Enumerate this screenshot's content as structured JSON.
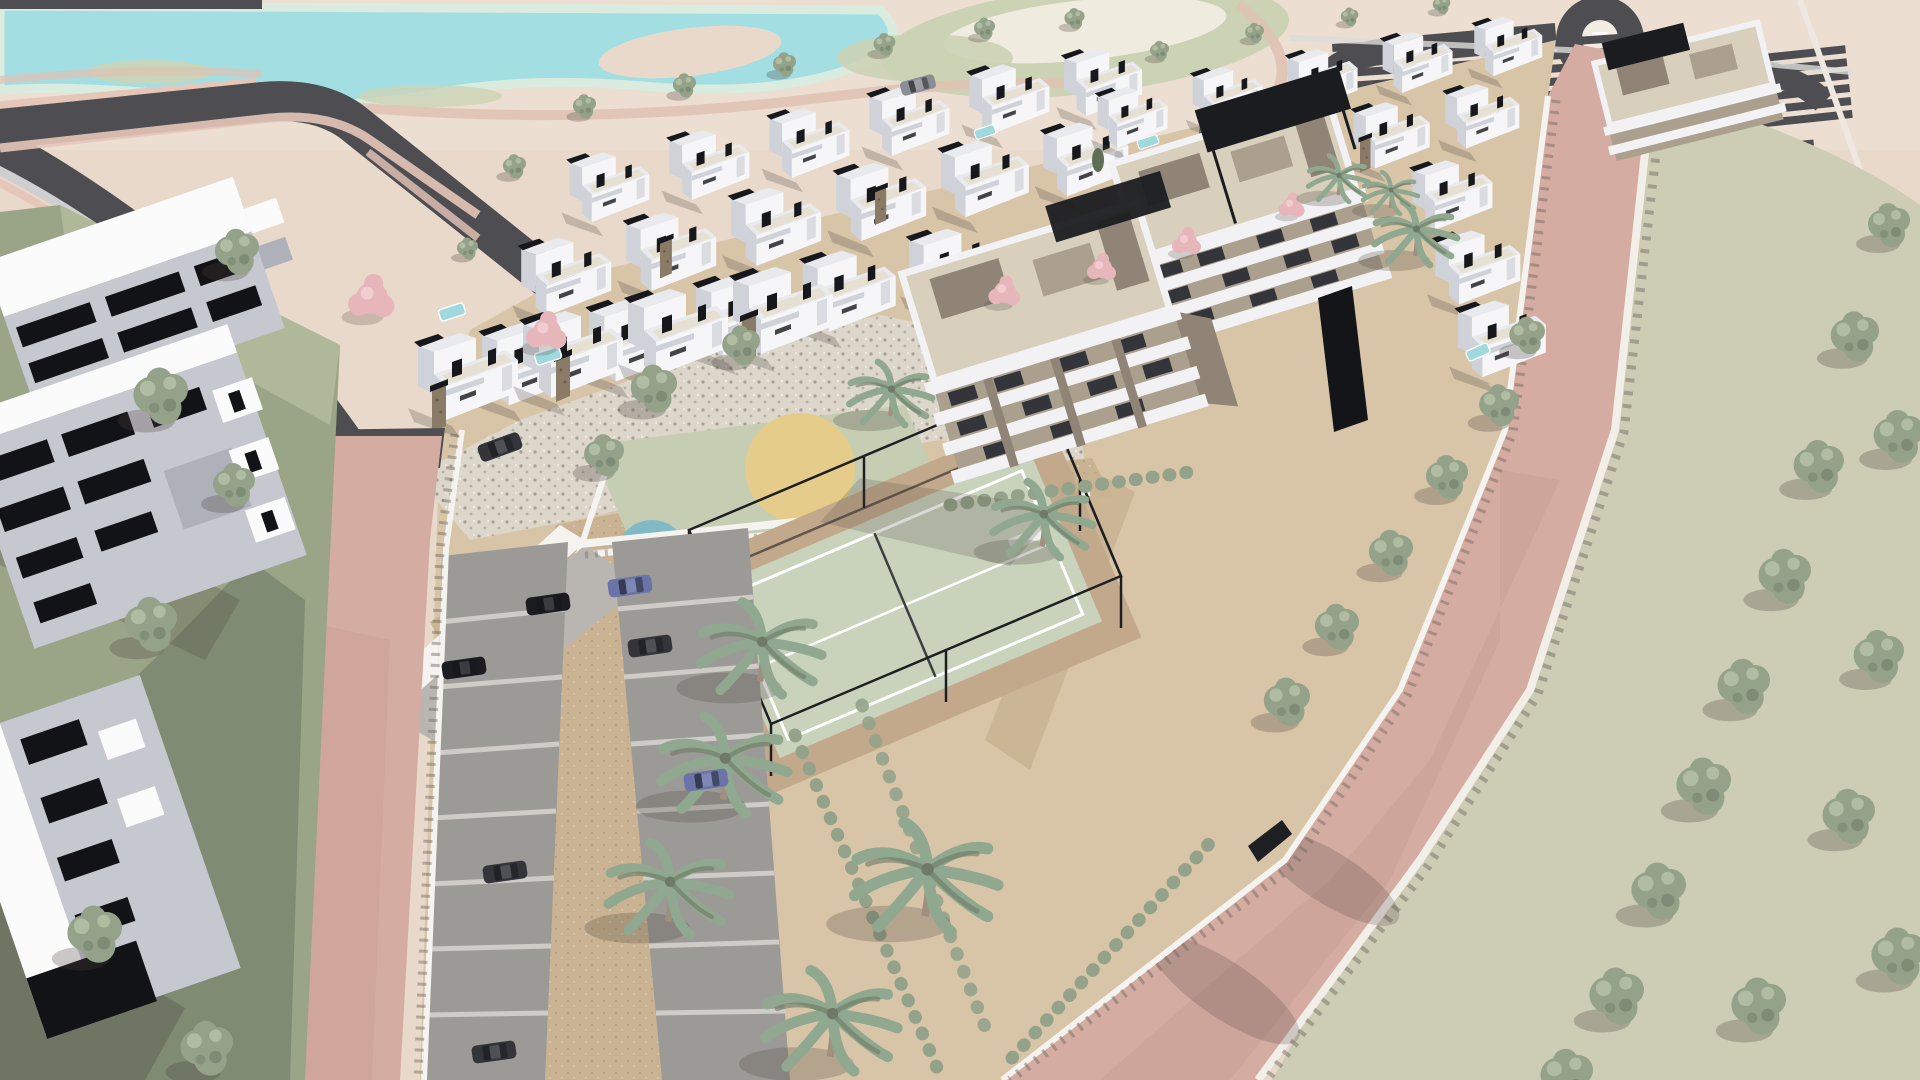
{
  "scene": {
    "type": "3d-architectural-render",
    "view": "aerial-perspective",
    "description": "Aerial visualization of a walled residential development: rows of white two-storey villas, two taupe-and-white apartment blocks with rooftop pergolas, a fenced padel court, a children's playground with three colored circles, surface parking with cars, an underground-garage ramp, palm and street trees, pink asphalt perimeter roads, a lawn verge with a tree row, and a golf course with a turquoise lake behind."
  },
  "palette": {
    "bg_sand": "#e9d9ca",
    "sand_light": "#f0e4d7",
    "lake": "#a3dee3",
    "lake_rim": "#d9ecdf",
    "fairway": "#ccd3b5",
    "fairway_cream": "#f0ebdf",
    "ribbon_pink": "#dfc2b4",
    "road_dark": "#4e4e52",
    "road_pink": "#d5aca2",
    "road_pink_deep": "#c89d94",
    "curb_white": "#f2efe9",
    "verge": "#cdccb5",
    "sidewalk_gray": "#cfcfd1",
    "sidewalk_pink": "#e6c6b8",
    "plot_sand": "#d8c5a8",
    "cobble_base": "#dcd6cb",
    "cobble_dot": "#8e877c",
    "paver_tan": "#c9b392",
    "paver_dot": "#a98f6d",
    "stall_gray": "#9c9a97",
    "stall_line": "#cfccc7",
    "court_green": "#c9d3bc",
    "court_line": "#ffffff",
    "court_sand": "#c3a98c",
    "fence_dark": "#1e1f23",
    "wall_white": "#f4f3f0",
    "wall_shadow": "#6f665e",
    "villa_white": "#f6f6f8",
    "villa_side": "#cfd2d9",
    "villa_roof": "#e9eaee",
    "villa_terrace": "#e6e0d2",
    "villa_dark": "#17181b",
    "stone": "#8a7b66",
    "pool": "#9fd8dd",
    "apt_taupe": "#ab9f8e",
    "apt_taupe_dark": "#8f8475",
    "apt_deck": "#d8cfbd",
    "apt_white": "#f2f2f4",
    "apt_glass": "#33353a",
    "pergola": "#1b1c20",
    "play_pad": "#c5cdb3",
    "play_yellow": "#e5cc8a",
    "play_blue": "#82b9c6",
    "play_pink": "#e79fa7",
    "tree_green": "#93a289",
    "tree_green_dark": "#6e7a65",
    "tree_light": "#b8c4a9",
    "palm_green": "#8fa88f",
    "palm_trunk": "#a08f7e",
    "blossom": "#e7b6ba",
    "cypress": "#5d6e55",
    "bldg_gray": "#c6c8cf",
    "bldg_side": "#aeb1b9",
    "bldg_window": "#121317",
    "roof_white": "#fbfbfc",
    "grass_strip": "#9aa487",
    "grass_strip_dark": "#76836c",
    "grass_strip_light": "#b9c0a2",
    "shadow": "#4a423c",
    "car_dark": "#33353b",
    "car_black": "#1b1c20",
    "car_blue": "#6a74a8",
    "car_gray": "#8b8e96"
  },
  "objects": {
    "development": {
      "villas_visible": 34,
      "apartment_buildings": 3,
      "rooftop_pergolas": 2,
      "perimeter_wall": true
    },
    "amenities": [
      "padel-court",
      "children-playground",
      "surface-parking",
      "underground-garage-ramp"
    ],
    "playground_circles": [
      "#e5cc8a",
      "#82b9c6",
      "#e79fa7"
    ],
    "vehicles": {
      "count": 9,
      "colors": [
        "#33353b",
        "#1b1c20",
        "#6a74a8",
        "#8b8e96"
      ]
    },
    "landscape": [
      "golf-lake",
      "fairways",
      "palm-trees",
      "street-trees",
      "lawn-verge",
      "blossom-trees",
      "hedges"
    ],
    "infrastructure": [
      "dark-asphalt-streets",
      "roundabout",
      "pink-perimeter-roads",
      "future-parking-strips",
      "cobble-plaza"
    ]
  }
}
